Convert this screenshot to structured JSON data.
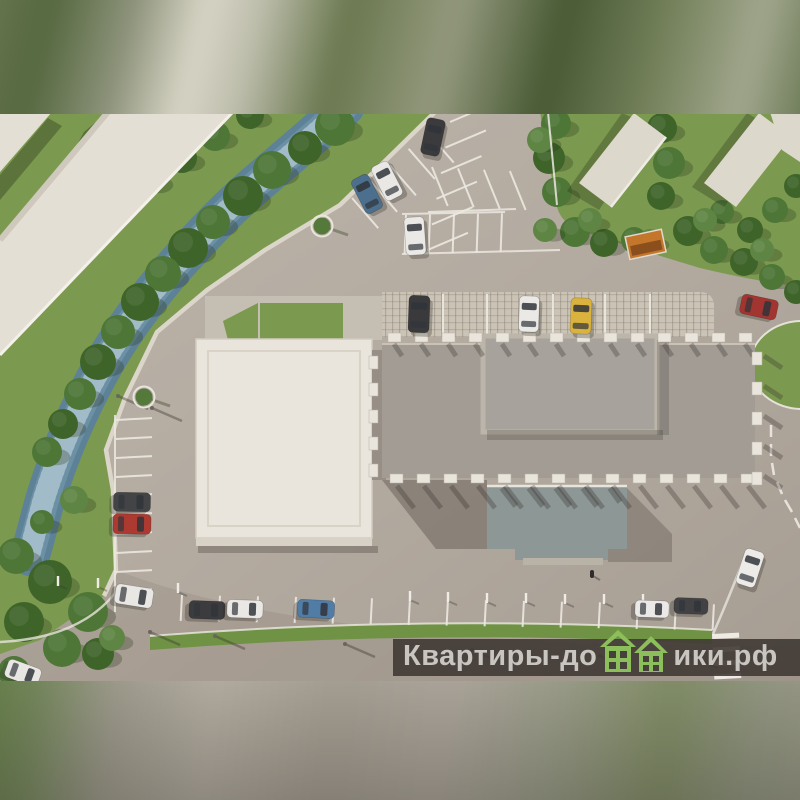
{
  "watermark": {
    "text_left": "Квартиры-до",
    "text_right": "ики.рф",
    "bg": "rgba(64,58,52,0.9)",
    "text_color": "#c9c6c2",
    "logo_green": "#8dbe5c",
    "logo_green_dark": "#6fa23e",
    "logo_window": "#46403b"
  },
  "palette": {
    "asphalt": "#b5ada3",
    "grass": "#7b9a4f",
    "grass_strip": "#6f9245",
    "river": "#5d8197",
    "river_light": "#7ea3b5",
    "white_roof": "#e9e5dd",
    "left_building": "#e4dfd4",
    "main_roof": "#a29c95",
    "penthouse": "#a7a29b",
    "penthouse_frame": "#bcb5aa",
    "annex_roof": "#8d9796",
    "pave": "#cbc3b6",
    "sidewalk": "#c5beb2",
    "wall": "#dcd6ca",
    "orange_shed": "#c4772b",
    "tree_shades": [
      "#4e7637",
      "#3f6429",
      "#5f8544"
    ]
  },
  "scene": {
    "cars": [
      [
        433,
        137,
        37,
        19,
        12,
        "#3b3b3d"
      ],
      [
        367,
        194,
        38,
        19,
        -27,
        "#4c6f8d"
      ],
      [
        387,
        181,
        38,
        19,
        -27,
        "#e9e8e5"
      ],
      [
        415,
        236,
        38,
        20,
        -4,
        "#ebe9e6"
      ],
      [
        419,
        314,
        37,
        21,
        2,
        "#3a393b"
      ],
      [
        529,
        314,
        36,
        20,
        2,
        "#ebe9e6"
      ],
      [
        581,
        316,
        36,
        21,
        2,
        "#d9b33d"
      ],
      [
        759,
        307,
        37,
        20,
        102,
        "#a33530"
      ],
      [
        132,
        502,
        37,
        19,
        91,
        "#434446"
      ],
      [
        132,
        524,
        38,
        20,
        91,
        "#ad3a31"
      ],
      [
        134,
        596,
        38,
        20,
        99,
        "#e9e7e4"
      ],
      [
        207,
        610,
        36,
        18,
        92,
        "#3c3c3e"
      ],
      [
        245,
        609,
        36,
        18,
        92,
        "#eae8e5"
      ],
      [
        316,
        609,
        37,
        18,
        93,
        "#507ca5"
      ],
      [
        652,
        609,
        34,
        17,
        92,
        "#ebe9e7"
      ],
      [
        691,
        606,
        34,
        16,
        92,
        "#424244"
      ],
      [
        23,
        673,
        35,
        19,
        110,
        "#e9e7e4"
      ],
      [
        750,
        568,
        37,
        20,
        18,
        "#ecebe8"
      ]
    ],
    "trees": [
      [
        335,
        126,
        20,
        0
      ],
      [
        305,
        148,
        17,
        1
      ],
      [
        272,
        170,
        19,
        0
      ],
      [
        243,
        196,
        20,
        1
      ],
      [
        213,
        222,
        17,
        0
      ],
      [
        188,
        248,
        20,
        1
      ],
      [
        163,
        274,
        18,
        0
      ],
      [
        140,
        302,
        19,
        1
      ],
      [
        118,
        332,
        17,
        0
      ],
      [
        98,
        362,
        18,
        1
      ],
      [
        80,
        394,
        16,
        0
      ],
      [
        63,
        424,
        15,
        1
      ],
      [
        47,
        452,
        15,
        0
      ],
      [
        250,
        115,
        14,
        1
      ],
      [
        215,
        136,
        15,
        0
      ],
      [
        182,
        158,
        15,
        1
      ],
      [
        150,
        180,
        15,
        0
      ],
      [
        118,
        204,
        14,
        1
      ],
      [
        88,
        228,
        14,
        0
      ],
      [
        58,
        252,
        13,
        1
      ],
      [
        30,
        278,
        13,
        0
      ],
      [
        8,
        305,
        12,
        1
      ],
      [
        74,
        500,
        14,
        2
      ],
      [
        42,
        522,
        12,
        0
      ],
      [
        16,
        556,
        18,
        0
      ],
      [
        50,
        582,
        22,
        1
      ],
      [
        88,
        612,
        20,
        0
      ],
      [
        24,
        622,
        20,
        1
      ],
      [
        62,
        648,
        19,
        0
      ],
      [
        98,
        654,
        16,
        1
      ],
      [
        14,
        672,
        16,
        0
      ],
      [
        112,
        638,
        13,
        2
      ],
      [
        556,
        124,
        15,
        0
      ],
      [
        549,
        158,
        16,
        1
      ],
      [
        557,
        192,
        15,
        0
      ],
      [
        662,
        128,
        15,
        1
      ],
      [
        669,
        163,
        16,
        0
      ],
      [
        661,
        196,
        14,
        1
      ],
      [
        575,
        232,
        15,
        0
      ],
      [
        604,
        243,
        14,
        1
      ],
      [
        634,
        240,
        13,
        0
      ],
      [
        688,
        231,
        15,
        1
      ],
      [
        714,
        250,
        14,
        0
      ],
      [
        744,
        262,
        14,
        1
      ],
      [
        772,
        277,
        13,
        0
      ],
      [
        796,
        292,
        12,
        1
      ],
      [
        722,
        212,
        12,
        0
      ],
      [
        750,
        230,
        13,
        1
      ],
      [
        775,
        210,
        13,
        0
      ],
      [
        796,
        186,
        12,
        1
      ],
      [
        540,
        140,
        13,
        2
      ],
      [
        590,
        220,
        12,
        2
      ],
      [
        650,
        240,
        11,
        2
      ],
      [
        705,
        220,
        12,
        2
      ],
      [
        762,
        250,
        12,
        2
      ],
      [
        545,
        230,
        12,
        2
      ]
    ],
    "stall_groups": [
      {
        "x": 352,
        "y": 198,
        "ax": -41,
        "sp": 25,
        "n": 5,
        "len": 40,
        "tx": 49
      },
      {
        "x": 450,
        "y": 122,
        "ax": 100,
        "sp": 26,
        "n": 6,
        "len": 44,
        "tx": -23
      },
      {
        "x": 432,
        "y": 167,
        "ax": 3,
        "sp": 26,
        "n": 4,
        "len": 42,
        "tx": 68
      },
      {
        "x": 406,
        "y": 215,
        "ax": -1,
        "sp": 24,
        "n": 5,
        "len": 39,
        "tx": 92
      },
      {
        "x": 116,
        "y": 420,
        "ax": 90,
        "sp": 19,
        "n": 10,
        "len": 36,
        "tx": -3
      },
      {
        "x": 182,
        "y": 595,
        "ax": 1,
        "sp": 38,
        "n": 15,
        "len": 26,
        "tx": 93
      }
    ],
    "lines": [
      [
        436,
        113,
        543,
        113
      ],
      [
        428,
        212,
        516,
        209
      ],
      [
        402,
        254,
        560,
        250
      ],
      [
        402,
        214,
        505,
        212
      ],
      [
        115,
        415,
        115,
        612
      ],
      [
        548,
        112,
        557,
        205
      ]
    ],
    "dashes": [
      [
        771,
        425,
        771,
        437
      ],
      [
        771,
        444,
        771,
        456
      ],
      [
        772,
        463,
        774,
        475
      ],
      [
        777,
        482,
        782,
        494
      ],
      [
        785,
        500,
        792,
        512
      ],
      [
        795,
        518,
        800,
        528
      ]
    ],
    "tab_rows": [
      {
        "x": 388,
        "y": 333,
        "dx": 27,
        "dy": 0,
        "n": 14,
        "w": 13,
        "h": 9,
        "sh": "top"
      },
      {
        "x": 390,
        "y": 474,
        "dx": 27,
        "dy": 0,
        "n": 14,
        "w": 13,
        "h": 9,
        "sh": "ground"
      },
      {
        "x": 369,
        "y": 356,
        "dx": 0,
        "dy": 27,
        "n": 5,
        "w": 9,
        "h": 13,
        "sh": "none"
      },
      {
        "x": 752,
        "y": 352,
        "dx": 0,
        "dy": 30,
        "n": 5,
        "w": 10,
        "h": 13,
        "sh": "right"
      }
    ],
    "lamps": [
      [
        118,
        396
      ],
      [
        152,
        408
      ],
      [
        150,
        632
      ],
      [
        215,
        636
      ],
      [
        345,
        644
      ],
      [
        472,
        650
      ],
      [
        600,
        656
      ],
      [
        688,
        655
      ]
    ],
    "bollards": [
      [
        58,
        585
      ],
      [
        98,
        587
      ],
      [
        178,
        592
      ],
      [
        410,
        600
      ],
      [
        448,
        601
      ],
      [
        487,
        602
      ],
      [
        526,
        602
      ],
      [
        565,
        603
      ],
      [
        604,
        603
      ],
      [
        643,
        603
      ]
    ],
    "ring_trees": [
      [
        144,
        397
      ],
      [
        322,
        226
      ]
    ],
    "zebra": {
      "x": 712,
      "y": 634,
      "w": 27,
      "h": 5,
      "gap": 8.5,
      "n": 6,
      "rot": -3
    }
  }
}
